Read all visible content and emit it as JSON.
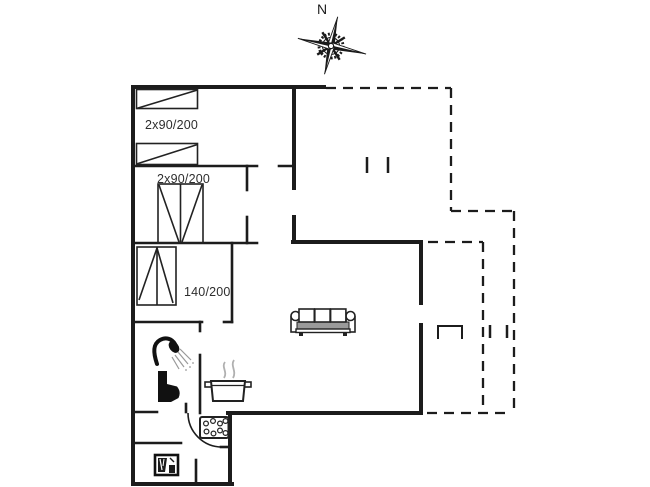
{
  "compass": {
    "north_label": "N"
  },
  "bed_labels": {
    "bedroom1": "2x90/200",
    "bedroom2": "2x90/200",
    "bedroom3": "140/200"
  },
  "icons": {
    "compass_rose": "compass-rose-icon",
    "sofa": "sofa-icon",
    "cooking_pot": "cooking-pot-icon",
    "shower": "shower-icon",
    "toilet": "toilet-icon",
    "stove_burners": "stove-burners-icon",
    "washing_machine": "washing-machine-icon",
    "door_swing": "door-swing-arc"
  },
  "colors": {
    "background": "#ffffff",
    "wall": "#1c1c1c",
    "label_text": "#2e2e2e",
    "steam_gray": "#b0b0b0",
    "sofa_seat_gray": "#9a9a9a"
  }
}
